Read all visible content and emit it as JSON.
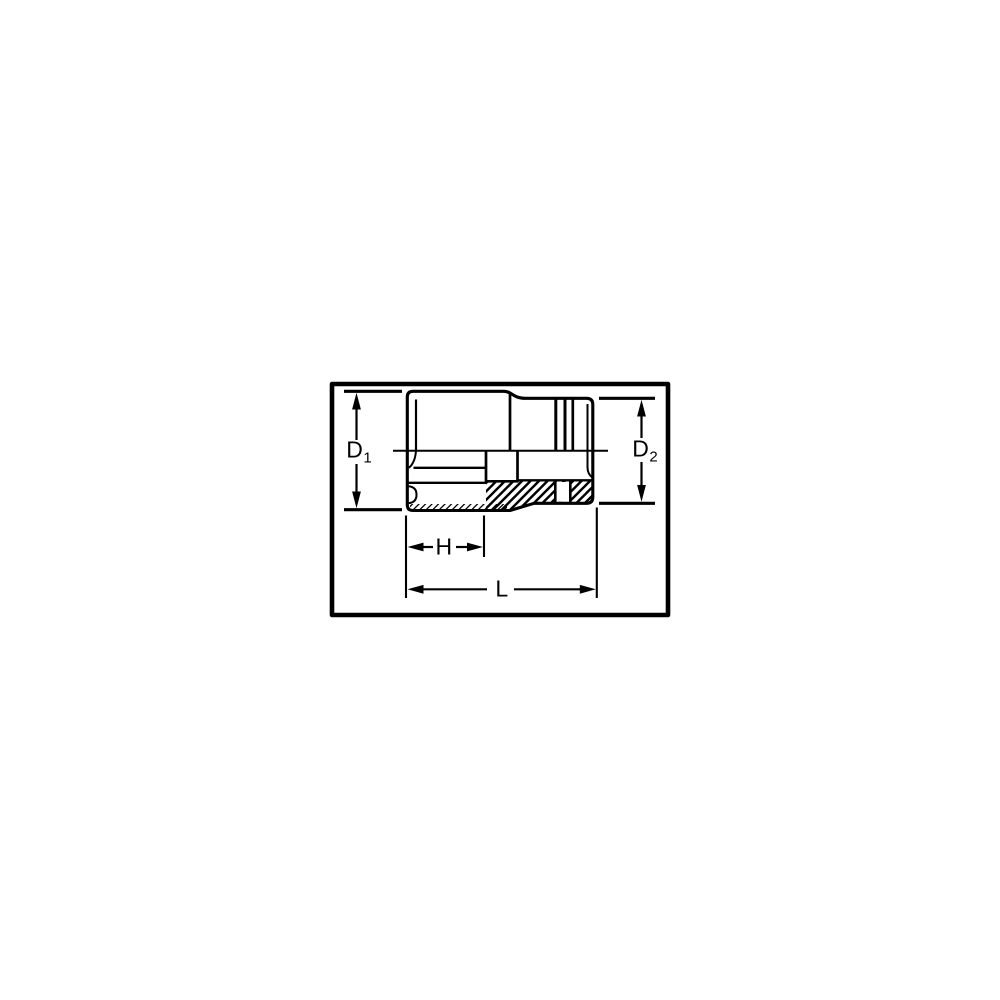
{
  "page": {
    "background_color": "#ffffff",
    "line_color": "#000000"
  },
  "diagram": {
    "kind": "socket-cross-section-dimension-drawing",
    "dimension_labels": {
      "d1": {
        "base": "D",
        "sub": "1"
      },
      "d2": {
        "base": "D",
        "sub": "2"
      },
      "h": {
        "text": "H"
      },
      "l": {
        "text": "L"
      }
    }
  }
}
